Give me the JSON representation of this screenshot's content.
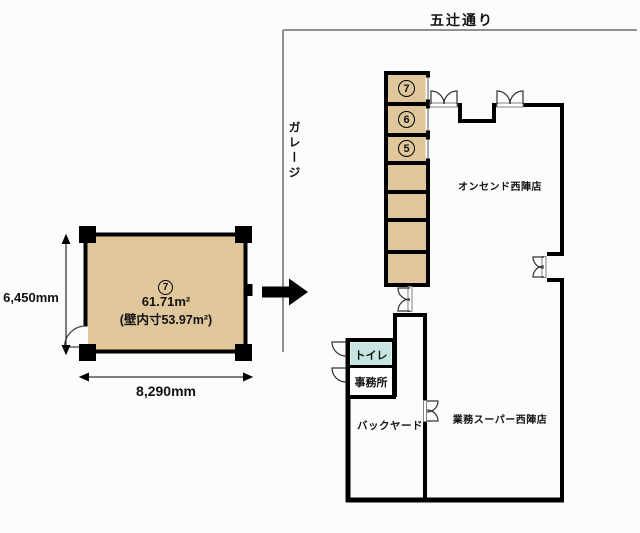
{
  "street": {
    "name": "五辻通り"
  },
  "garage": {
    "name": "ガレージ"
  },
  "detail_plan": {
    "unit_number": "7",
    "area": "61.71m²",
    "inner_wall_area": "(壁内寸53.97m²)",
    "width_mm": "8,290mm",
    "height_mm": "6,450mm"
  },
  "site_plan": {
    "stack_units": [
      "7",
      "6",
      "5"
    ],
    "stores": {
      "onsendo": "オンセンド西陣店",
      "gyomu_super": "業務スーパー西陣店"
    },
    "rooms": {
      "toilet": "トイレ",
      "office": "事務所",
      "backyard": "バックヤード"
    }
  },
  "colors": {
    "unit_fill": "#dfc79b",
    "toilet_fill": "#c6e5e2",
    "wall": "#000000",
    "street_line": "#919191"
  }
}
